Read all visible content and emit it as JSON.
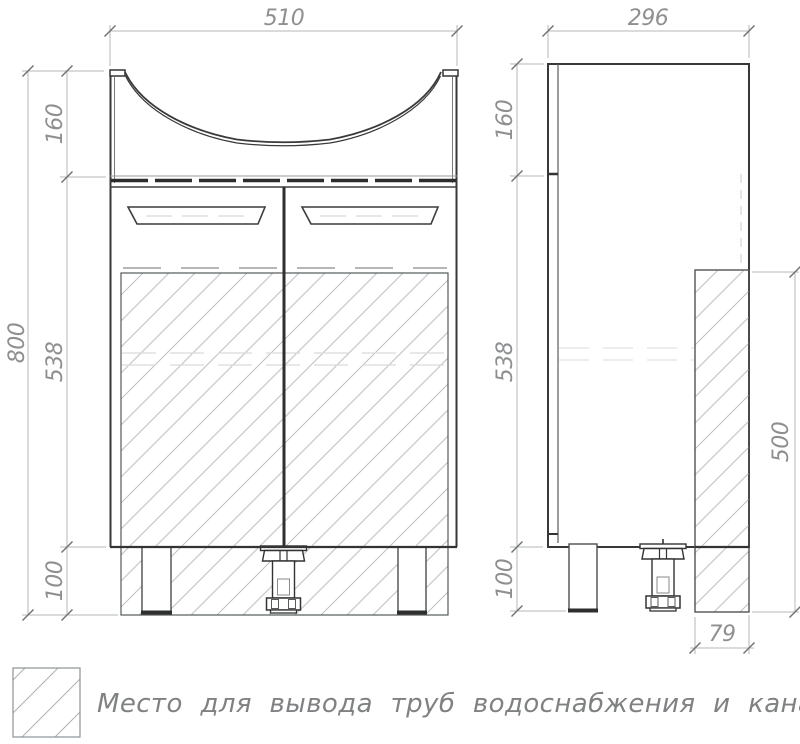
{
  "drawing": {
    "type": "technical-drawing",
    "subject": "bathroom vanity cabinet with basin, front and side views",
    "units": "mm",
    "colors": {
      "outline": "#3a3a3a",
      "hatch": "#bdc0c3",
      "dimension_lines": "#b4b7b9",
      "dimension_text": "#8d8f91",
      "background": "#ffffff"
    },
    "dims": {
      "front_width": "510",
      "front_sink_h": "160",
      "front_body_h": "538",
      "front_leg_h": "100",
      "front_total_h": "800",
      "side_depth": "296",
      "side_sink_h": "160",
      "side_body_h": "538",
      "side_leg_h": "100",
      "pipe_zone_h": "500",
      "pipe_zone_w": "79"
    },
    "legend": {
      "text": "Место для вывода труб водоснабжения и канализации"
    }
  }
}
